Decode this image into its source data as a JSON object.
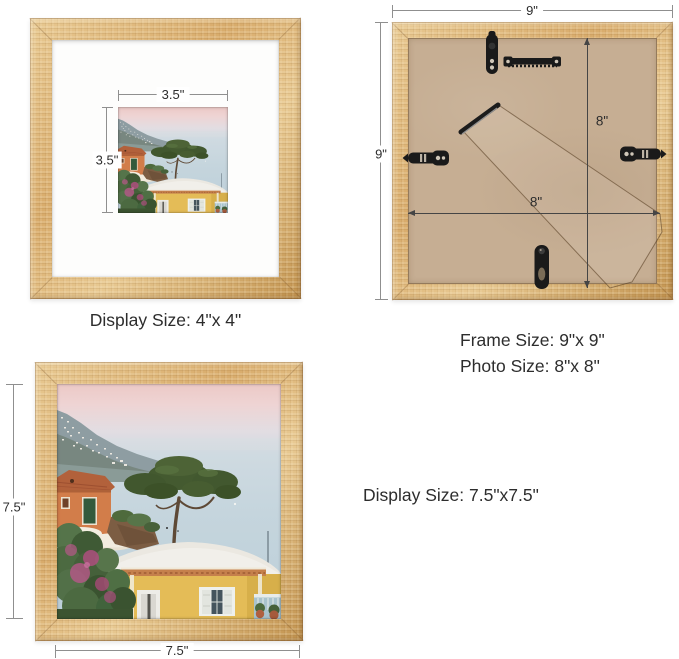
{
  "front_mat_view": {
    "photo_width_label": "3.5\"",
    "photo_height_label": "3.5\"",
    "caption": "Display Size: 4\"x 4\""
  },
  "back_view": {
    "frame_width_label": "9\"",
    "frame_height_label": "9\"",
    "opening_height_label": "8\"",
    "opening_width_label": "8\"",
    "caption_frame_size": "Frame Size: 9\"x 9\"",
    "caption_photo_size": "Photo Size: 8\"x 8\""
  },
  "front_full_view": {
    "display_height_label": "7.5\"",
    "display_width_label": "7.5\"",
    "caption": "Display Size: 7.5\"x7.5\""
  },
  "media": {
    "photo_alt": "coastal village scene with umbrella pine, orange villa and yellow house by the sea"
  },
  "colors": {
    "page_bg": "#ffffff",
    "wood": "#d8ab6b",
    "wood_light": "#e8c992",
    "wood_dark": "#c2934f",
    "mat_white": "#fdfdfc",
    "backboard": "#c6ae93",
    "hardware_black": "#1a1a1a",
    "dim_line": "#8f8f8f",
    "dim_dark": "#454545",
    "text": "#2d2d2d"
  }
}
